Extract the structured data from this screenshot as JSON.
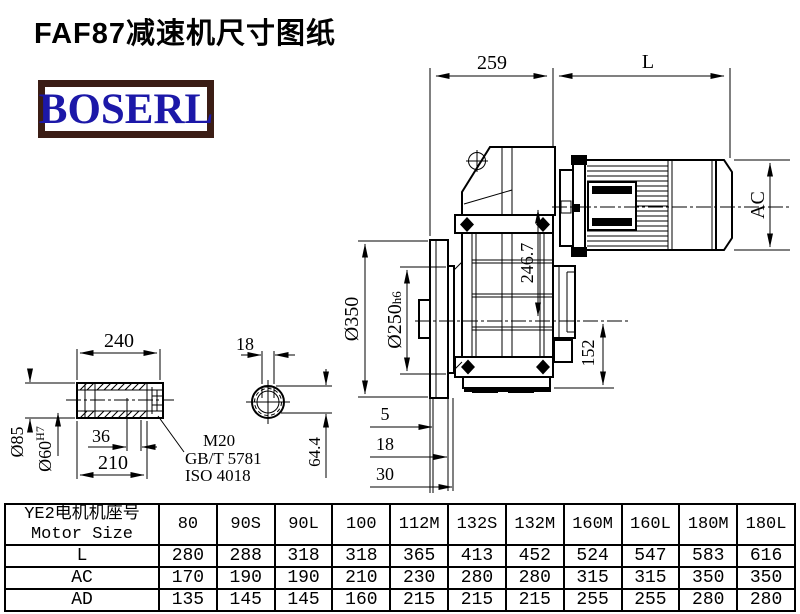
{
  "title": "FAF87减速机尺寸图纸",
  "logo": {
    "text": "BOSERL"
  },
  "drawing": {
    "top": {
      "d259": "259",
      "L": "L"
    },
    "motor": {
      "AC": "AC"
    },
    "gearbox": {
      "d246": "246.7",
      "d152": "152"
    },
    "flange": {
      "d350": "Ø350",
      "d250": "Ø250",
      "d250tol": "h6",
      "d5": "5",
      "d18": "18",
      "d30": "30"
    },
    "shaft": {
      "d240": "240",
      "d36": "36",
      "d210": "210",
      "d85": "Ø85",
      "d60": "Ø60",
      "d60tol": "H7",
      "m20": "M20",
      "gbt": "GB/T 5781",
      "iso": "ISO 4018"
    },
    "keyway": {
      "d18": "18",
      "d644": "64.4"
    }
  },
  "table": {
    "header": {
      "zh": "YE2电机机座号",
      "en": "Motor Size"
    },
    "columns": [
      "80",
      "90S",
      "90L",
      "100",
      "112M",
      "132S",
      "132M",
      "160M",
      "160L",
      "180M",
      "180L"
    ],
    "rows": [
      {
        "label": "L",
        "values": [
          "280",
          "288",
          "318",
          "318",
          "365",
          "413",
          "452",
          "524",
          "547",
          "583",
          "616"
        ]
      },
      {
        "label": "AC",
        "values": [
          "170",
          "190",
          "190",
          "210",
          "230",
          "280",
          "280",
          "315",
          "315",
          "350",
          "350"
        ]
      },
      {
        "label": "AD",
        "values": [
          "135",
          "145",
          "145",
          "160",
          "215",
          "215",
          "215",
          "255",
          "255",
          "280",
          "280"
        ]
      }
    ]
  }
}
